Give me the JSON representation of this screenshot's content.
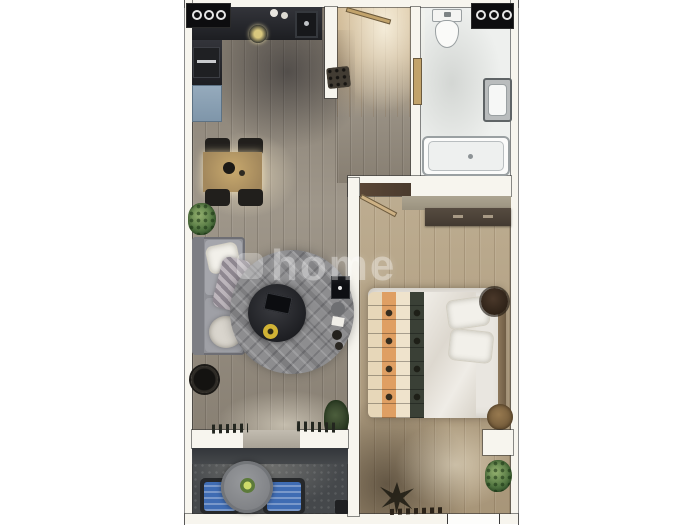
{
  "watermark": {
    "text": "home"
  },
  "palette": {
    "background": "#ffffff",
    "wall": "#f7f5ee",
    "wall_outline": "#3a3a3a",
    "floor_living": "#948b7d",
    "floor_bedroom": "#b4a284",
    "floor_hall": "#c7b291",
    "floor_bathroom": "#eef0ee",
    "floor_balcony": "#45484b",
    "kitchen_counter": "#26262b",
    "fridge_blue": "#8ba2b5",
    "sofa_grey": "#94959b",
    "rug_grey": "#8d8d8f",
    "bed_linen": "#e9e6e0",
    "blanket_orange": "#df9f63",
    "balcony_chair_blue": "#3f6cb3",
    "plant_green": "#537742",
    "dining_table_wood": "#b59a6b",
    "door_wood": "#c2a36b"
  }
}
